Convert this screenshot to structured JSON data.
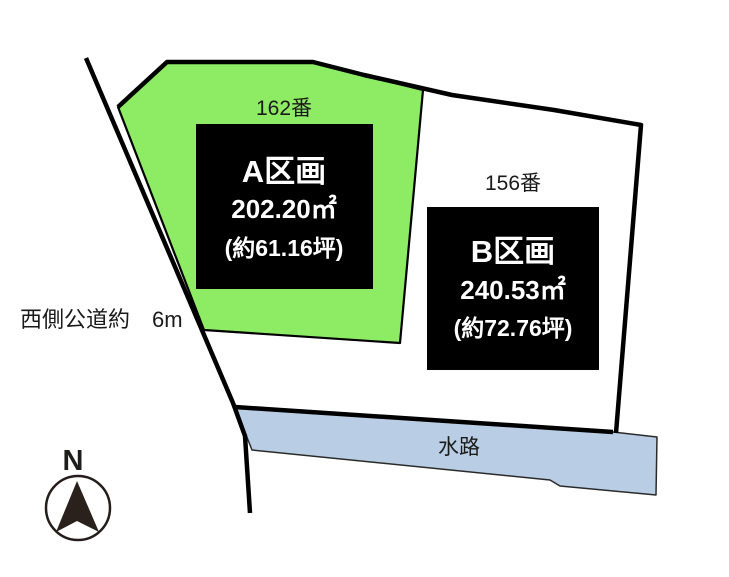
{
  "diagram": {
    "title": "land-parcel-layout",
    "background": "#ffffff",
    "colors": {
      "boundary_line": "#000000",
      "parcel_a_fill": "#8deb64",
      "parcel_b_fill": "#ffffff",
      "waterway_fill": "#b9cde4",
      "info_box_bg": "#000000",
      "info_box_text": "#ffffff",
      "label_text": "#1a1a1a",
      "compass_needle": "#2b211c"
    },
    "parcels": [
      {
        "id": "A",
        "lot_number": "162番",
        "name": "A区画",
        "area_m2": "202.20㎡",
        "area_tsubo": "(約61.16坪)",
        "fill": "#8deb64"
      },
      {
        "id": "B",
        "lot_number": "156番",
        "name": "B区画",
        "area_m2": "240.53㎡",
        "area_tsubo": "(約72.76坪)",
        "fill": "#ffffff"
      }
    ],
    "labels": {
      "west_road": "西側公道約　6m",
      "waterway": "水路",
      "compass_north": "N"
    }
  }
}
